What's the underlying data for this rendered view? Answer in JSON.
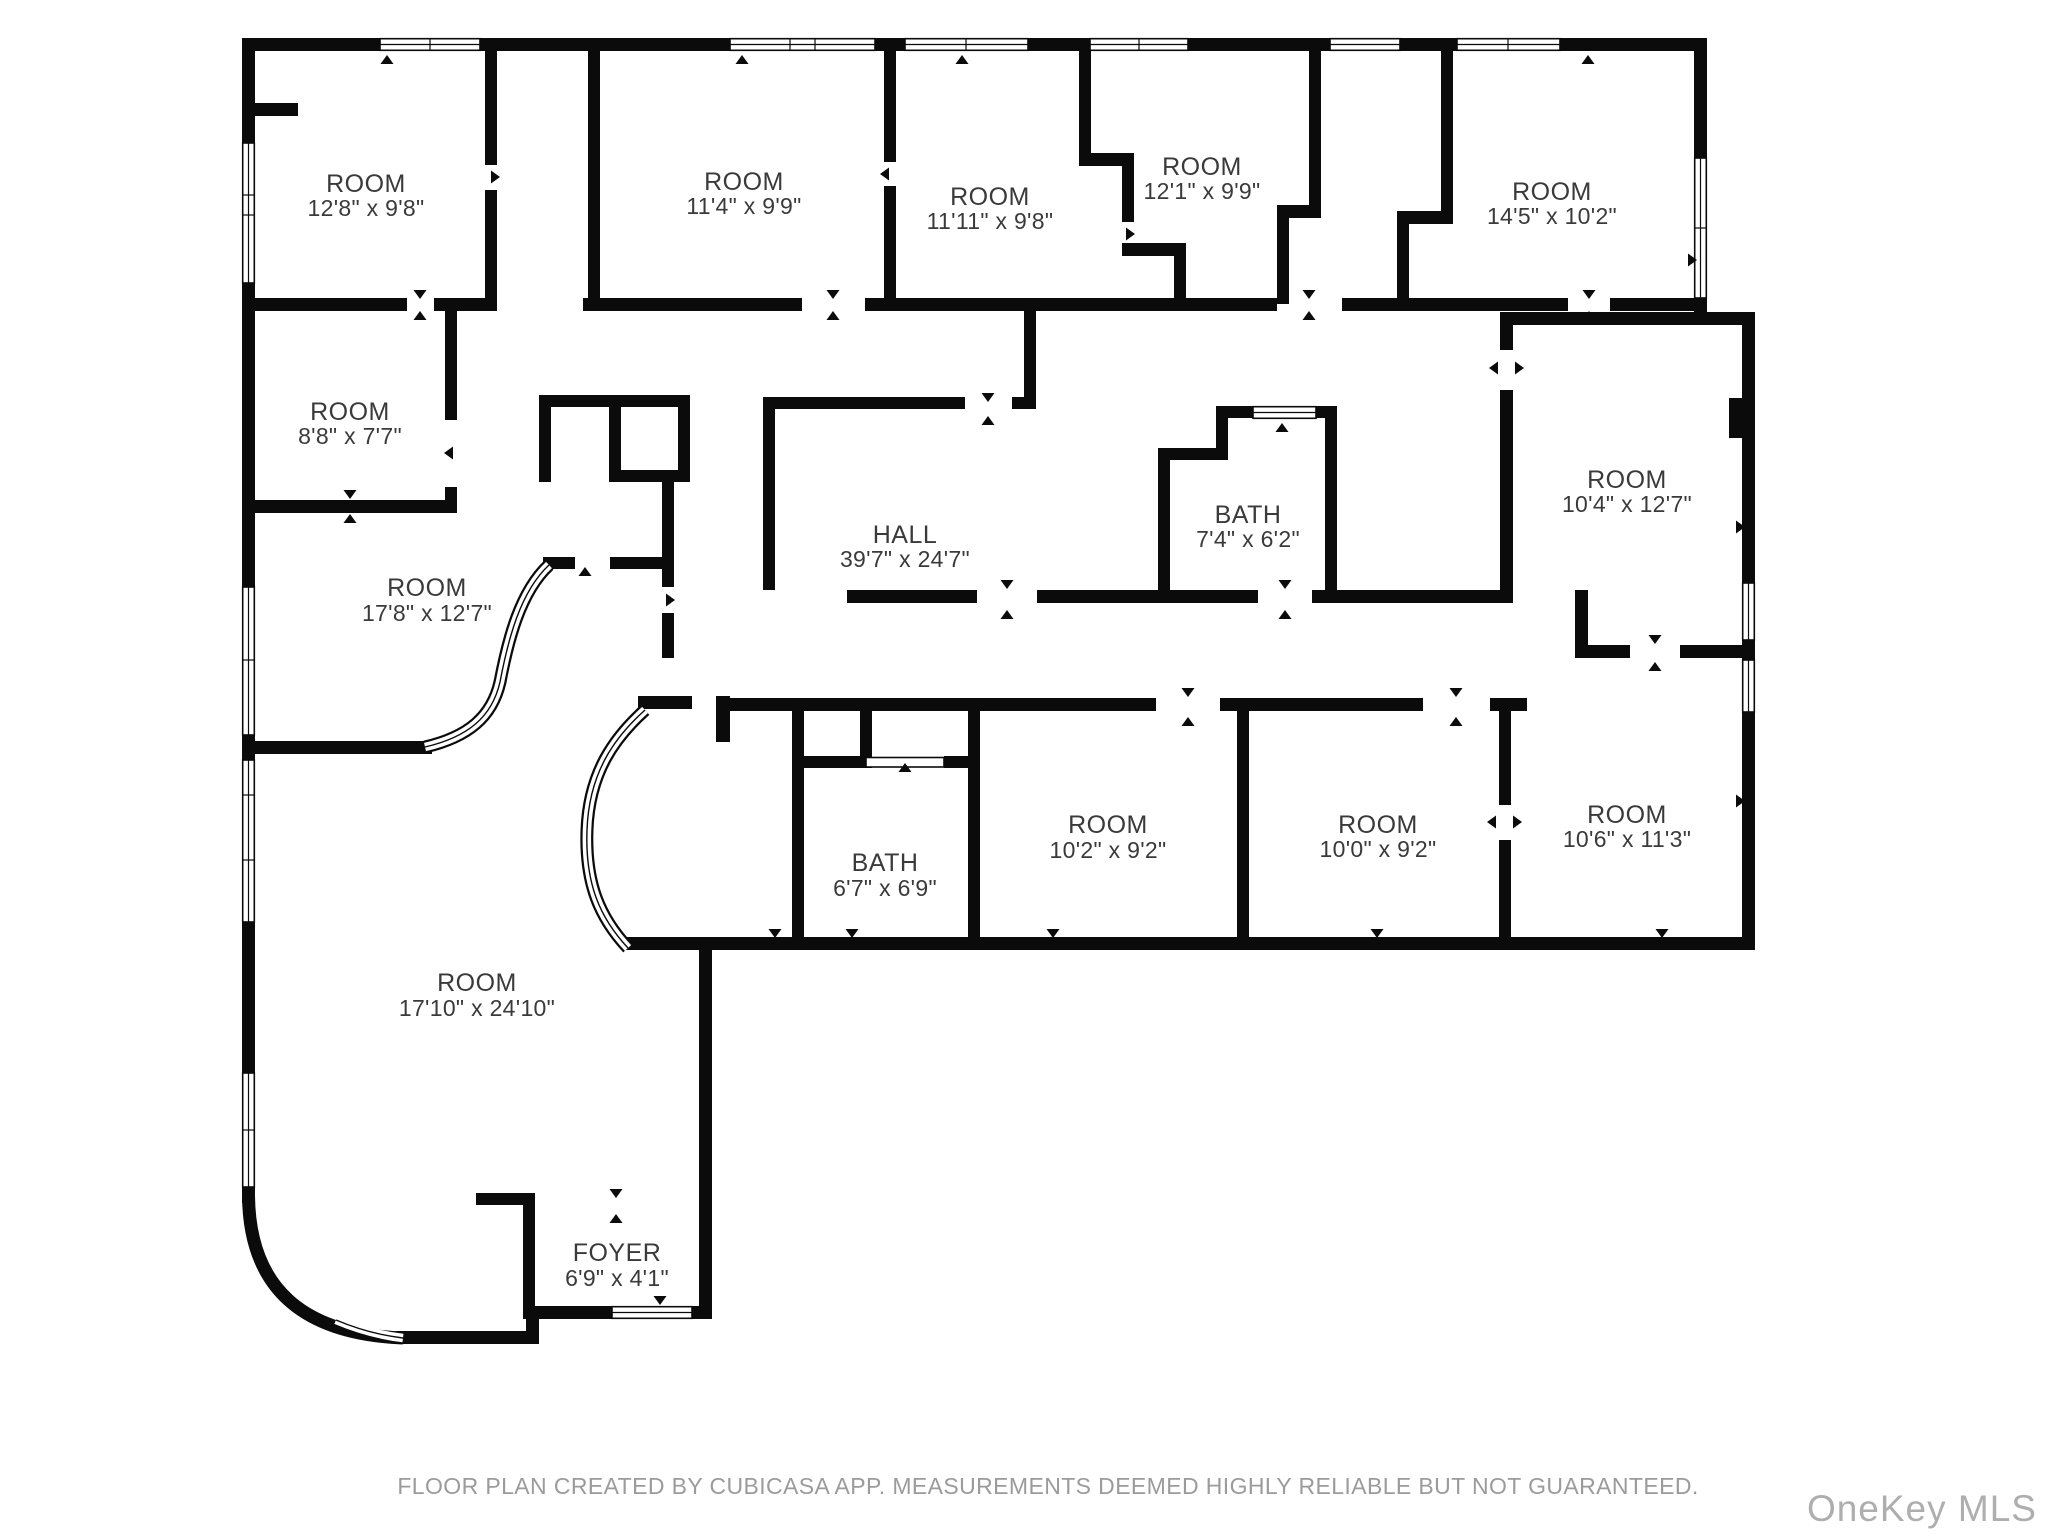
{
  "floorplan": {
    "rooms": [
      {
        "name": "ROOM",
        "dims": "12'8\" x 9'8\""
      },
      {
        "name": "ROOM",
        "dims": "11'4\" x 9'9\""
      },
      {
        "name": "ROOM",
        "dims": "11'11\" x 9'8\""
      },
      {
        "name": "ROOM",
        "dims": "12'1\" x 9'9\""
      },
      {
        "name": "ROOM",
        "dims": "14'5\" x 10'2\""
      },
      {
        "name": "ROOM",
        "dims": "8'8\" x 7'7\""
      },
      {
        "name": "ROOM",
        "dims": "17'8\" x 12'7\""
      },
      {
        "name": "HALL",
        "dims": "39'7\" x 24'7\""
      },
      {
        "name": "BATH",
        "dims": "7'4\" x 6'2\""
      },
      {
        "name": "ROOM",
        "dims": "10'4\" x 12'7\""
      },
      {
        "name": "BATH",
        "dims": "6'7\" x 6'9\""
      },
      {
        "name": "ROOM",
        "dims": "10'2\" x 9'2\""
      },
      {
        "name": "ROOM",
        "dims": "10'0\" x 9'2\""
      },
      {
        "name": "ROOM",
        "dims": "10'6\" x 11'3\""
      },
      {
        "name": "ROOM",
        "dims": "17'10\" x 24'10\""
      },
      {
        "name": "FOYER",
        "dims": "6'9\" x 4'1\""
      }
    ],
    "footer": "FLOOR PLAN CREATED BY CUBICASA APP. MEASUREMENTS DEEMED HIGHLY RELIABLE BUT NOT GUARANTEED.",
    "watermark": "OneKey MLS",
    "colors": {
      "wall": "#0b0b0b",
      "label": "#3a3a3a",
      "footer": "#9b9b9b",
      "watermark": "#aeaeae"
    }
  }
}
